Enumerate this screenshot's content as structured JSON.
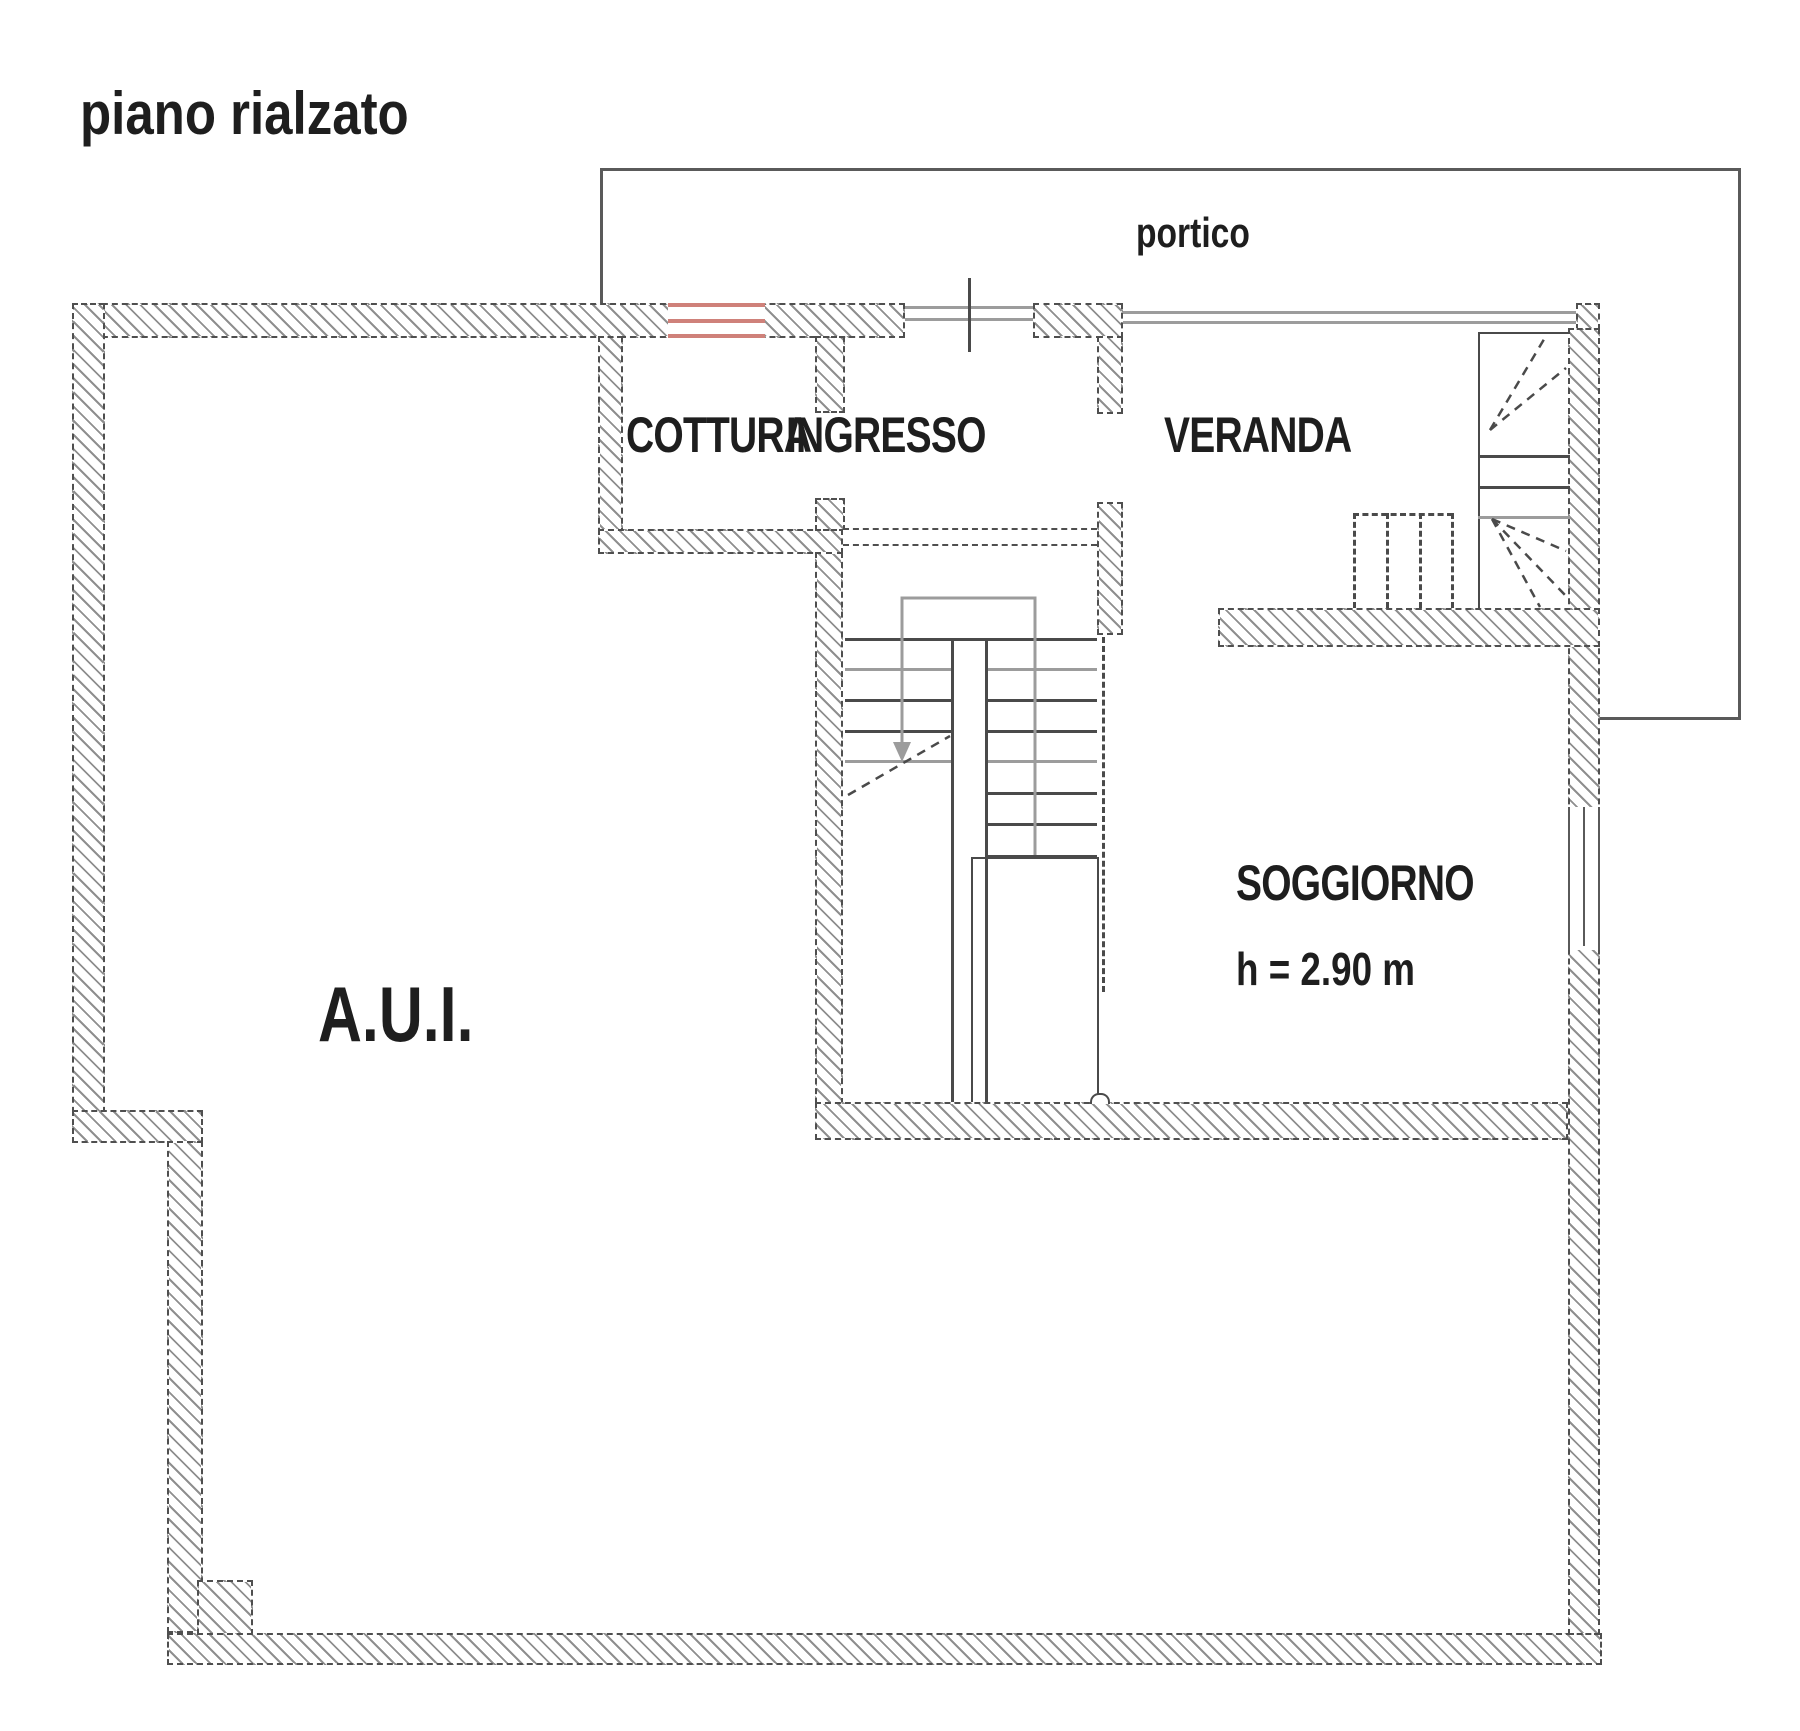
{
  "plan": {
    "title": "piano rialzato",
    "labels": {
      "portico": "portico",
      "cottura": "COTTURA",
      "ingresso": "INGRESSO",
      "veranda": "VERANDA",
      "soggiorno": "SOGGIORNO",
      "soggiorno_height": "h = 2.90 m",
      "aui": "A.U.I."
    },
    "colors": {
      "wall_line": "#4f4f4f",
      "hatch": "#8f8f8f",
      "window_red": "#cf817a",
      "thin_gray": "#9c9c9c",
      "text": "#1e1e1e"
    }
  }
}
